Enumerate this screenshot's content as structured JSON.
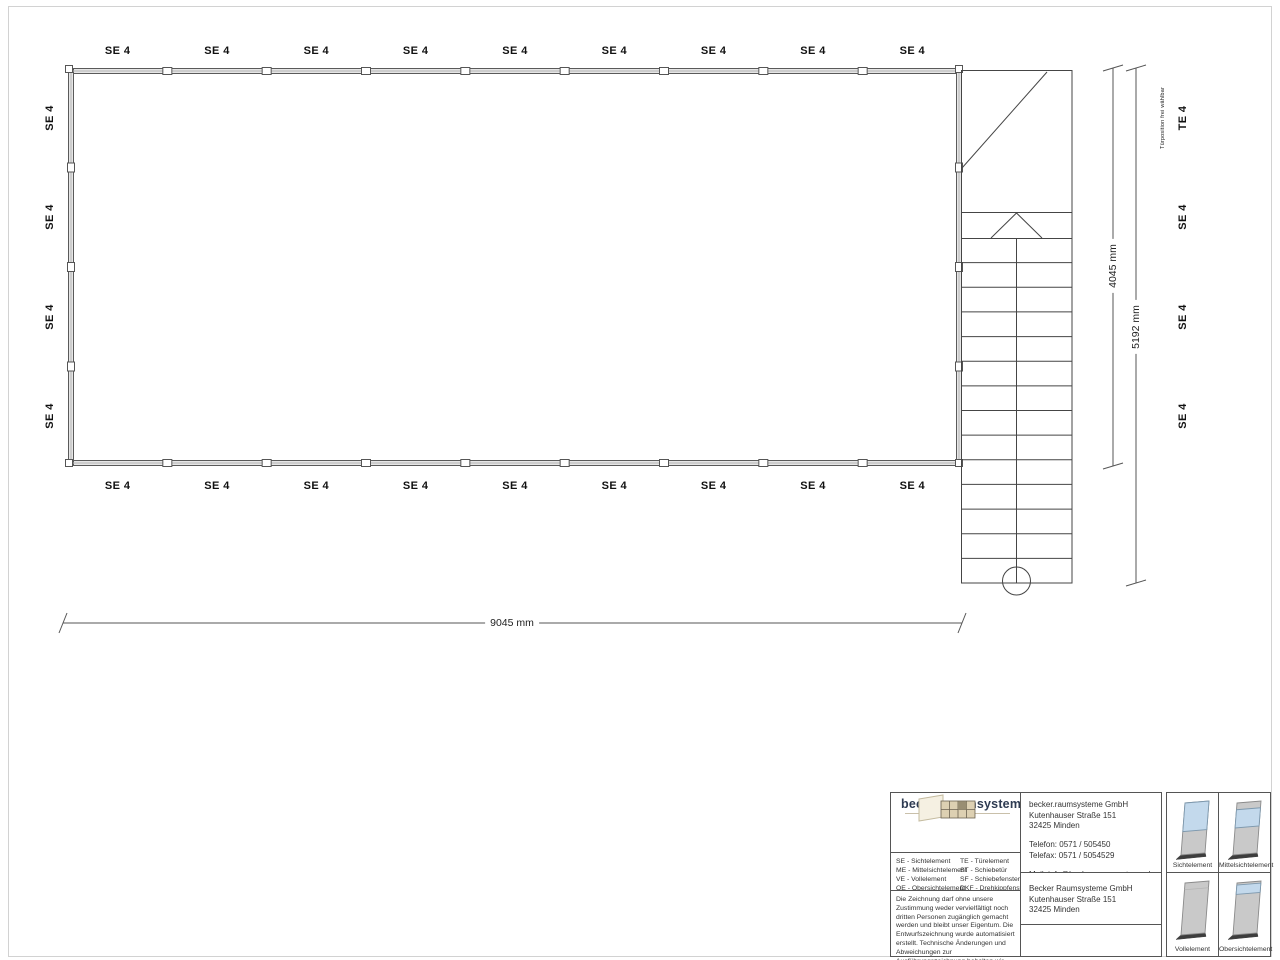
{
  "plan": {
    "top_labels": [
      "SE 4",
      "SE 4",
      "SE 4",
      "SE 4",
      "SE 4",
      "SE 4",
      "SE 4",
      "SE 4",
      "SE 4"
    ],
    "bottom_labels": [
      "SE 4",
      "SE 4",
      "SE 4",
      "SE 4",
      "SE 4",
      "SE 4",
      "SE 4",
      "SE 4",
      "SE 4"
    ],
    "left_labels": [
      "SE 4",
      "SE 4",
      "SE 4",
      "SE 4"
    ],
    "right_labels": [
      "TE 4",
      "SE 4",
      "SE 4",
      "SE 4"
    ],
    "door_note": "Türposition frei wählbar",
    "dimensions": {
      "width": "9045 mm",
      "room_height": "4045 mm",
      "total_height": "5192 mm"
    }
  },
  "title_block": {
    "logo_text": "becker.raumsysteme",
    "logo_mark": "®",
    "legend_left": [
      "SE - Sichtelement",
      "ME - Mittelsichtelement",
      "VE - Vollelement",
      "OE - Obersichtelement"
    ],
    "legend_right": [
      "TE - Türelement",
      "ST - Schiebetür",
      "SF - Schiebefenster",
      "DKF - Drehkippfenster"
    ],
    "contact_lines": [
      "becker.raumsysteme GmbH",
      "Kutenhauser Straße 151",
      "32425 Minden",
      "",
      "Telefon: 0571 / 505450",
      "Telefax: 0571 / 5054529",
      "",
      "Mail: info@becker-raumsysteme.de",
      "Web: www.becker-raumsysteme.de"
    ],
    "address_lines": [
      "Becker Raumsysteme GmbH",
      "Kutenhauser Straße 151",
      "32425 Minden"
    ],
    "disclaimer": "Die Zeichnung darf ohne unsere Zustimmung weder vervielfältigt noch dritten Personen zugänglich gemacht werden und bleibt unser Eigentum. Die Entwurfszeichnung wurde automatisiert erstellt. Technische Änderungen und Abweichungen zur Ausführungszeichnung behalten wir uns vor.",
    "element_cards": [
      {
        "name": "Sichtelement",
        "glass_from": 0.0,
        "glass_to": 0.55
      },
      {
        "name": "Mittelsichtelement",
        "glass_from": 0.13,
        "glass_to": 0.48
      },
      {
        "name": "Vollelement",
        "glass_from": null,
        "glass_to": null
      },
      {
        "name": "Obersichtelement",
        "glass_from": 0.04,
        "glass_to": 0.22
      }
    ]
  },
  "colors": {
    "line": "#3a3a3a",
    "dim_line": "#555555",
    "wall_fill": "#e6e6e6",
    "glass": "#c3d9ec",
    "glass_border": "#7d98ad",
    "panel": "#c9c9c9",
    "panel_border": "#8a8a8a",
    "panel_base": "#3d3d3d",
    "logo_text": "#2e3b52"
  }
}
